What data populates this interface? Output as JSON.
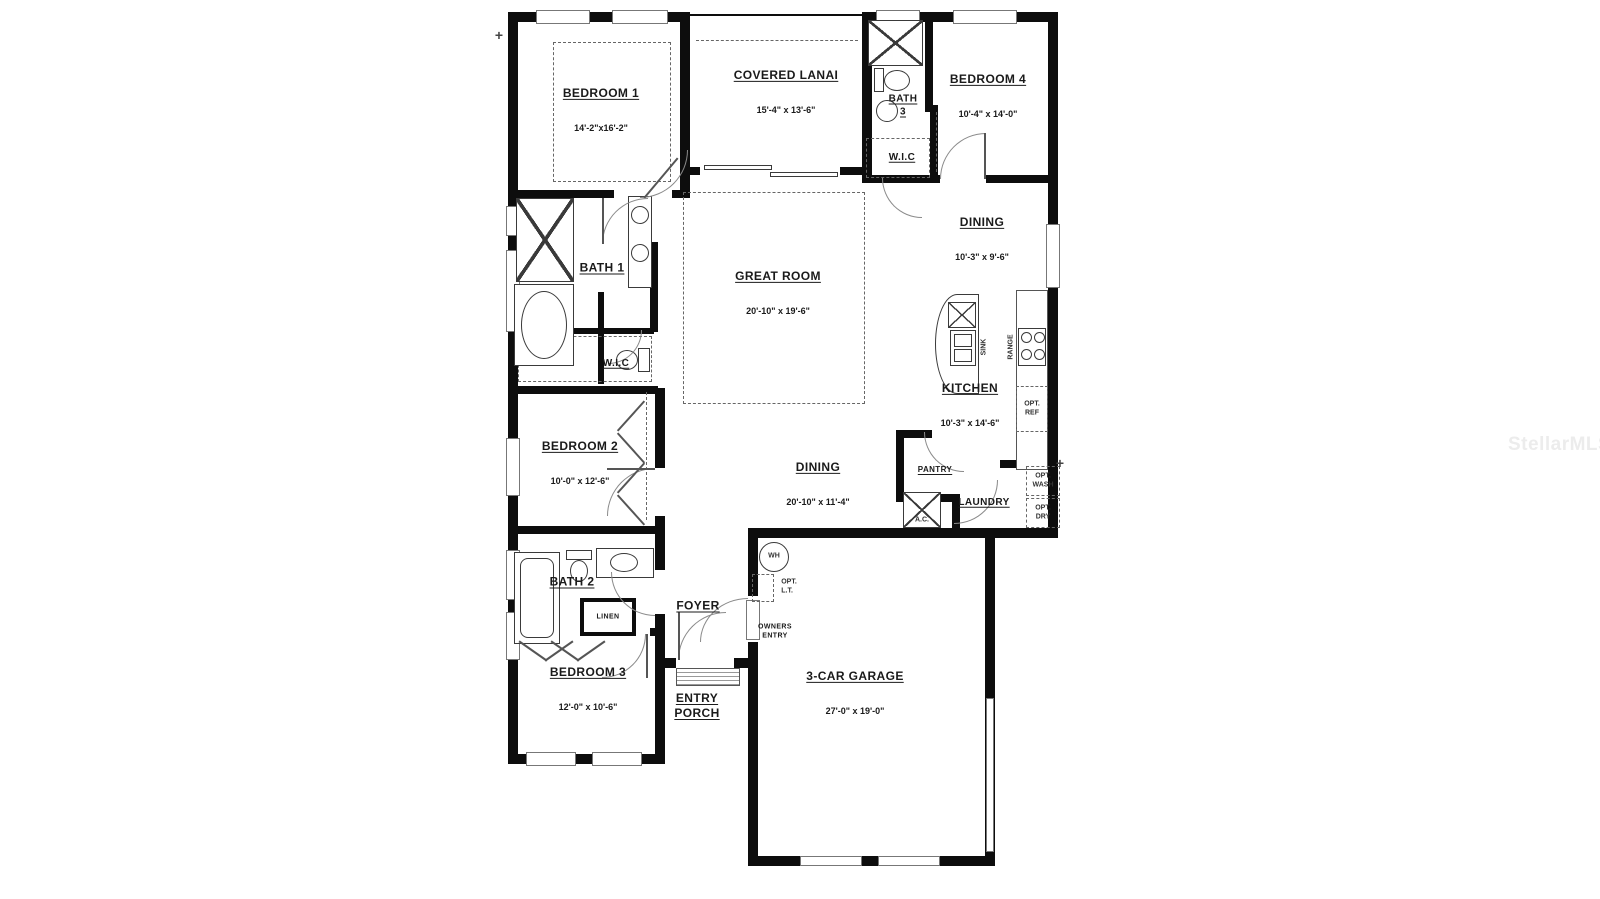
{
  "watermark": "StellarMLS",
  "rooms": {
    "bedroom1": {
      "name": "BEDROOM 1",
      "dims": "14'-2\"x16'-2\""
    },
    "covered_lanai": {
      "name": "COVERED LANAI",
      "dims": "15'-4\" x 13'-6\""
    },
    "bath3": {
      "name": "BATH\n3"
    },
    "bedroom4": {
      "name": "BEDROOM 4",
      "dims": "10'-4\" x 14'-0\""
    },
    "wic_upper": {
      "name": "W.I.C"
    },
    "dining_upper": {
      "name": "DINING",
      "dims": "10'-3\" x 9'-6\""
    },
    "great_room": {
      "name": "GREAT ROOM",
      "dims": "20'-10\" x 19'-6\""
    },
    "bath1": {
      "name": "BATH 1"
    },
    "wic_left": {
      "name": "W.I.C"
    },
    "bedroom2": {
      "name": "BEDROOM 2",
      "dims": "10'-0\" x 12'-6\""
    },
    "kitchen": {
      "name": "KITCHEN",
      "dims": "10'-3\" x 14'-6\""
    },
    "dining_center": {
      "name": "DINING",
      "dims": "20'-10\" x 11'-4\""
    },
    "pantry": {
      "name": "PANTRY"
    },
    "laundry": {
      "name": "LAUNDRY"
    },
    "bath2": {
      "name": "BATH 2"
    },
    "linen": {
      "name": "LINEN"
    },
    "bedroom3": {
      "name": "BEDROOM 3",
      "dims": "12'-0\" x 10'-6\""
    },
    "foyer": {
      "name": "FOYER"
    },
    "owners_entry": {
      "name": "OWNERS\nENTRY"
    },
    "entry_porch": {
      "name": "ENTRY\nPORCH"
    },
    "garage": {
      "name": "3-CAR GARAGE",
      "dims": "27'-0\" x 19'-0\""
    }
  },
  "fixtures": {
    "water_heater": "WH",
    "opt_laundry_tub": "OPT.\nL.T.",
    "ac_unit": "A.C.",
    "sink": "SINK",
    "range": "RANGE",
    "opt_ref": "OPT.\nREF",
    "opt_wash": "OPT.\nWASH",
    "opt_dry": "OPT.\nDRY"
  },
  "colors": {
    "wall": "#0d0d0d",
    "watermark": "#ececec"
  }
}
